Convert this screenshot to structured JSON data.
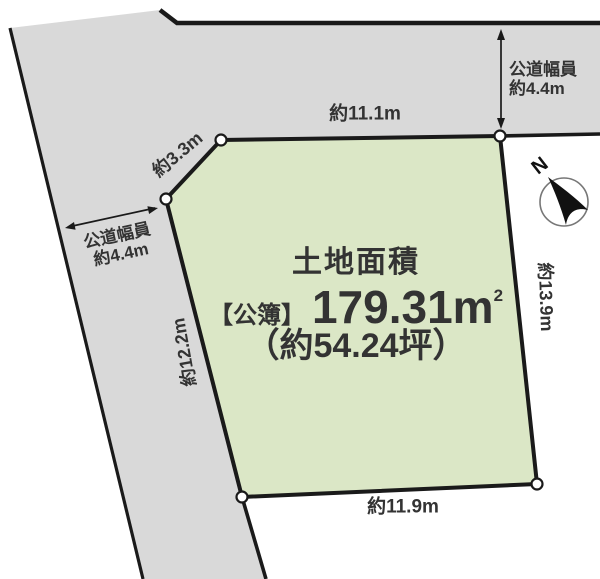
{
  "diagram": {
    "parcel": {
      "title": "土地面積",
      "area_prefix": "【公簿】",
      "area_value": "179.31",
      "area_unit_base": "m",
      "area_unit_sup": "2",
      "area_tsubo": "（約54.24坪）"
    },
    "dimensions": {
      "top": "約11.1m",
      "diagonal": "約3.3m",
      "left": "約12.2m",
      "right": "約13.9m",
      "bottom": "約11.9m"
    },
    "road_width_right": {
      "line1": "公道幅員",
      "line2": "約4.4m"
    },
    "road_width_left": {
      "line1": "公道幅員",
      "line2": "約4.4m"
    },
    "compass": {
      "label": "N"
    },
    "colors": {
      "parcel_fill": "#dbe7c6",
      "road_fill": "#d9d9d9",
      "line": "#1a1a1a"
    }
  }
}
